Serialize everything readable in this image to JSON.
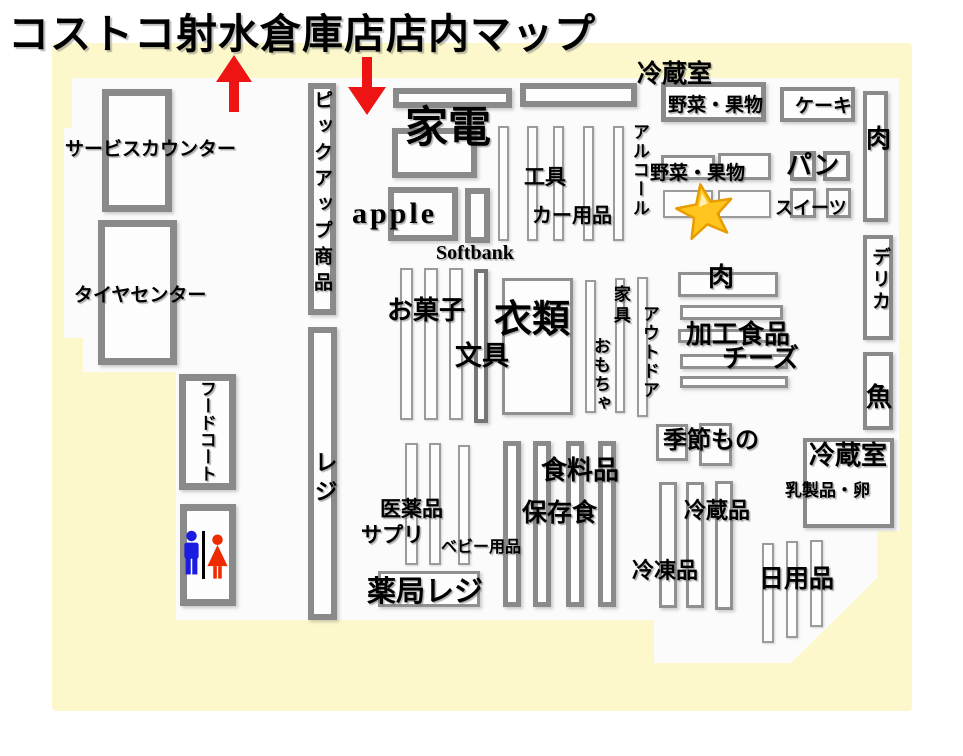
{
  "title": "コストコ射水倉庫店店内マップ",
  "colors": {
    "page_background": "#ffffff",
    "map_background": "#fcf8cb",
    "sales_floor": "#fbfbfc",
    "shelf_border": "#8a8a8a",
    "arrow_red": "#ee1414",
    "star_gold": "#ffc41e",
    "star_outline": "#e89c00",
    "restroom_men_blue": "#1c1ce0",
    "restroom_women_red": "#ee2b00",
    "text": "#000000"
  },
  "icons": {
    "exit_arrow": "red-up-arrow",
    "entrance_arrow": "red-down-arrow",
    "highlight_star": "gold-star-marker",
    "restroom_men": "men-figure",
    "restroom_women": "women-figure"
  },
  "labels": {
    "service_counter": "サービスカウンター",
    "tire_center": "タイヤセンター",
    "food_court": "フードコート",
    "pickup_items": "ピックアップ商品",
    "register": "レジ",
    "appliances": "家電",
    "apple": "apple",
    "softbank": "Softbank",
    "tools": "工具",
    "car_supplies": "カー用品",
    "alcohol": "アルコール",
    "fridge_room_top": "冷蔵室",
    "produce_top": "野菜・果物",
    "cake": "ケーキ",
    "meat_wall": "肉",
    "bread": "パン",
    "produce_mid": "野菜・果物",
    "sweets": "スイーツ",
    "deli": "デリカ",
    "meat_center": "肉",
    "processed_food": "加工食品",
    "cheese": "チーズ",
    "fish": "魚",
    "snacks": "お菓子",
    "clothing": "衣類",
    "stationery": "文具",
    "furniture": "家具",
    "toys": "おもちゃ",
    "outdoor": "アウトドア",
    "seasonal": "季節もの",
    "fridge_room_back": "冷蔵室",
    "dairy_eggs": "乳製品・卵",
    "groceries": "食料品",
    "preserved_food": "保存食",
    "medicine": "医薬品",
    "supplements": "サプリ",
    "baby_goods": "ベビー用品",
    "pharmacy_register": "薬局レジ",
    "chilled": "冷蔵品",
    "frozen": "冷凍品",
    "daily_goods": "日用品"
  }
}
